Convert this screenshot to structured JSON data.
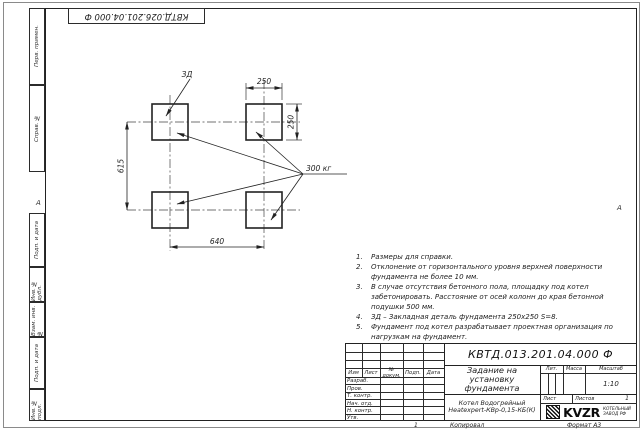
{
  "sheet": {
    "top_stamp": "КВТД.026.201.04.000 Ф",
    "fold_marks": {
      "left": "А",
      "right": "А"
    },
    "margin_columns": [
      {
        "label": "Перв. примен."
      },
      {
        "label": "Справ. №"
      },
      {
        "label": "Подп. и дата"
      },
      {
        "label": "Инв. № дубл."
      },
      {
        "label": "Взам. инв. №"
      },
      {
        "label": "Подп. и дата"
      },
      {
        "label": "Инв. № подл."
      }
    ],
    "footer": {
      "page_mark": "1",
      "kopiroval": "Копировал",
      "format": "Формат А3"
    }
  },
  "drawing": {
    "zd_label": "ЗД",
    "dim_top": "250",
    "dim_right": "250",
    "dim_left": "615",
    "dim_bottom": "640",
    "weight_label": "300 кг"
  },
  "notes": [
    {
      "num": "1.",
      "text": "Размеры для справки."
    },
    {
      "num": "2.",
      "text": "Отклонение от горизонтального уровня верхней поверхности фундамента не более 10 мм."
    },
    {
      "num": "3.",
      "text": "В случае отсутствия бетонного пола, площадку под котел забетонировать. Расстояние от осей колонн до края бетонной подушки 500 мм."
    },
    {
      "num": "4.",
      "text": "ЗД – Закладная деталь фундамента 250х250 S=8."
    },
    {
      "num": "5.",
      "text": "Фундамент под котел разрабатывает проектная организация по нагрузкам на фундамент."
    }
  ],
  "title_block": {
    "doc_number": "КВТД.013.201.04.000 Ф",
    "title_line1": "Задание на установку",
    "title_line2": "фундамента",
    "product_line1": "Котел Водогрейный",
    "product_line2": "Heatexpert-КВр-0,15-КБ(К)",
    "headers": {
      "izm": "Изм",
      "list": "Лист",
      "n_dokum": "№ докум.",
      "podp": "Подп.",
      "data": "Дата",
      "lit": "Лит.",
      "massa": "Масса",
      "masshtab": "Масштаб",
      "list2": "Лист",
      "listov": "Листов"
    },
    "rows": [
      "Разраб.",
      "Пров.",
      "Т. контр.",
      "Нач. отд.",
      "Н. контр.",
      "Утв."
    ],
    "scale": "1:10",
    "listov_value": "1",
    "logo": {
      "text": "KVZR",
      "sub1": "КОТЕЛЬНЫЙ",
      "sub2": "ЗАВОД РФ"
    }
  }
}
